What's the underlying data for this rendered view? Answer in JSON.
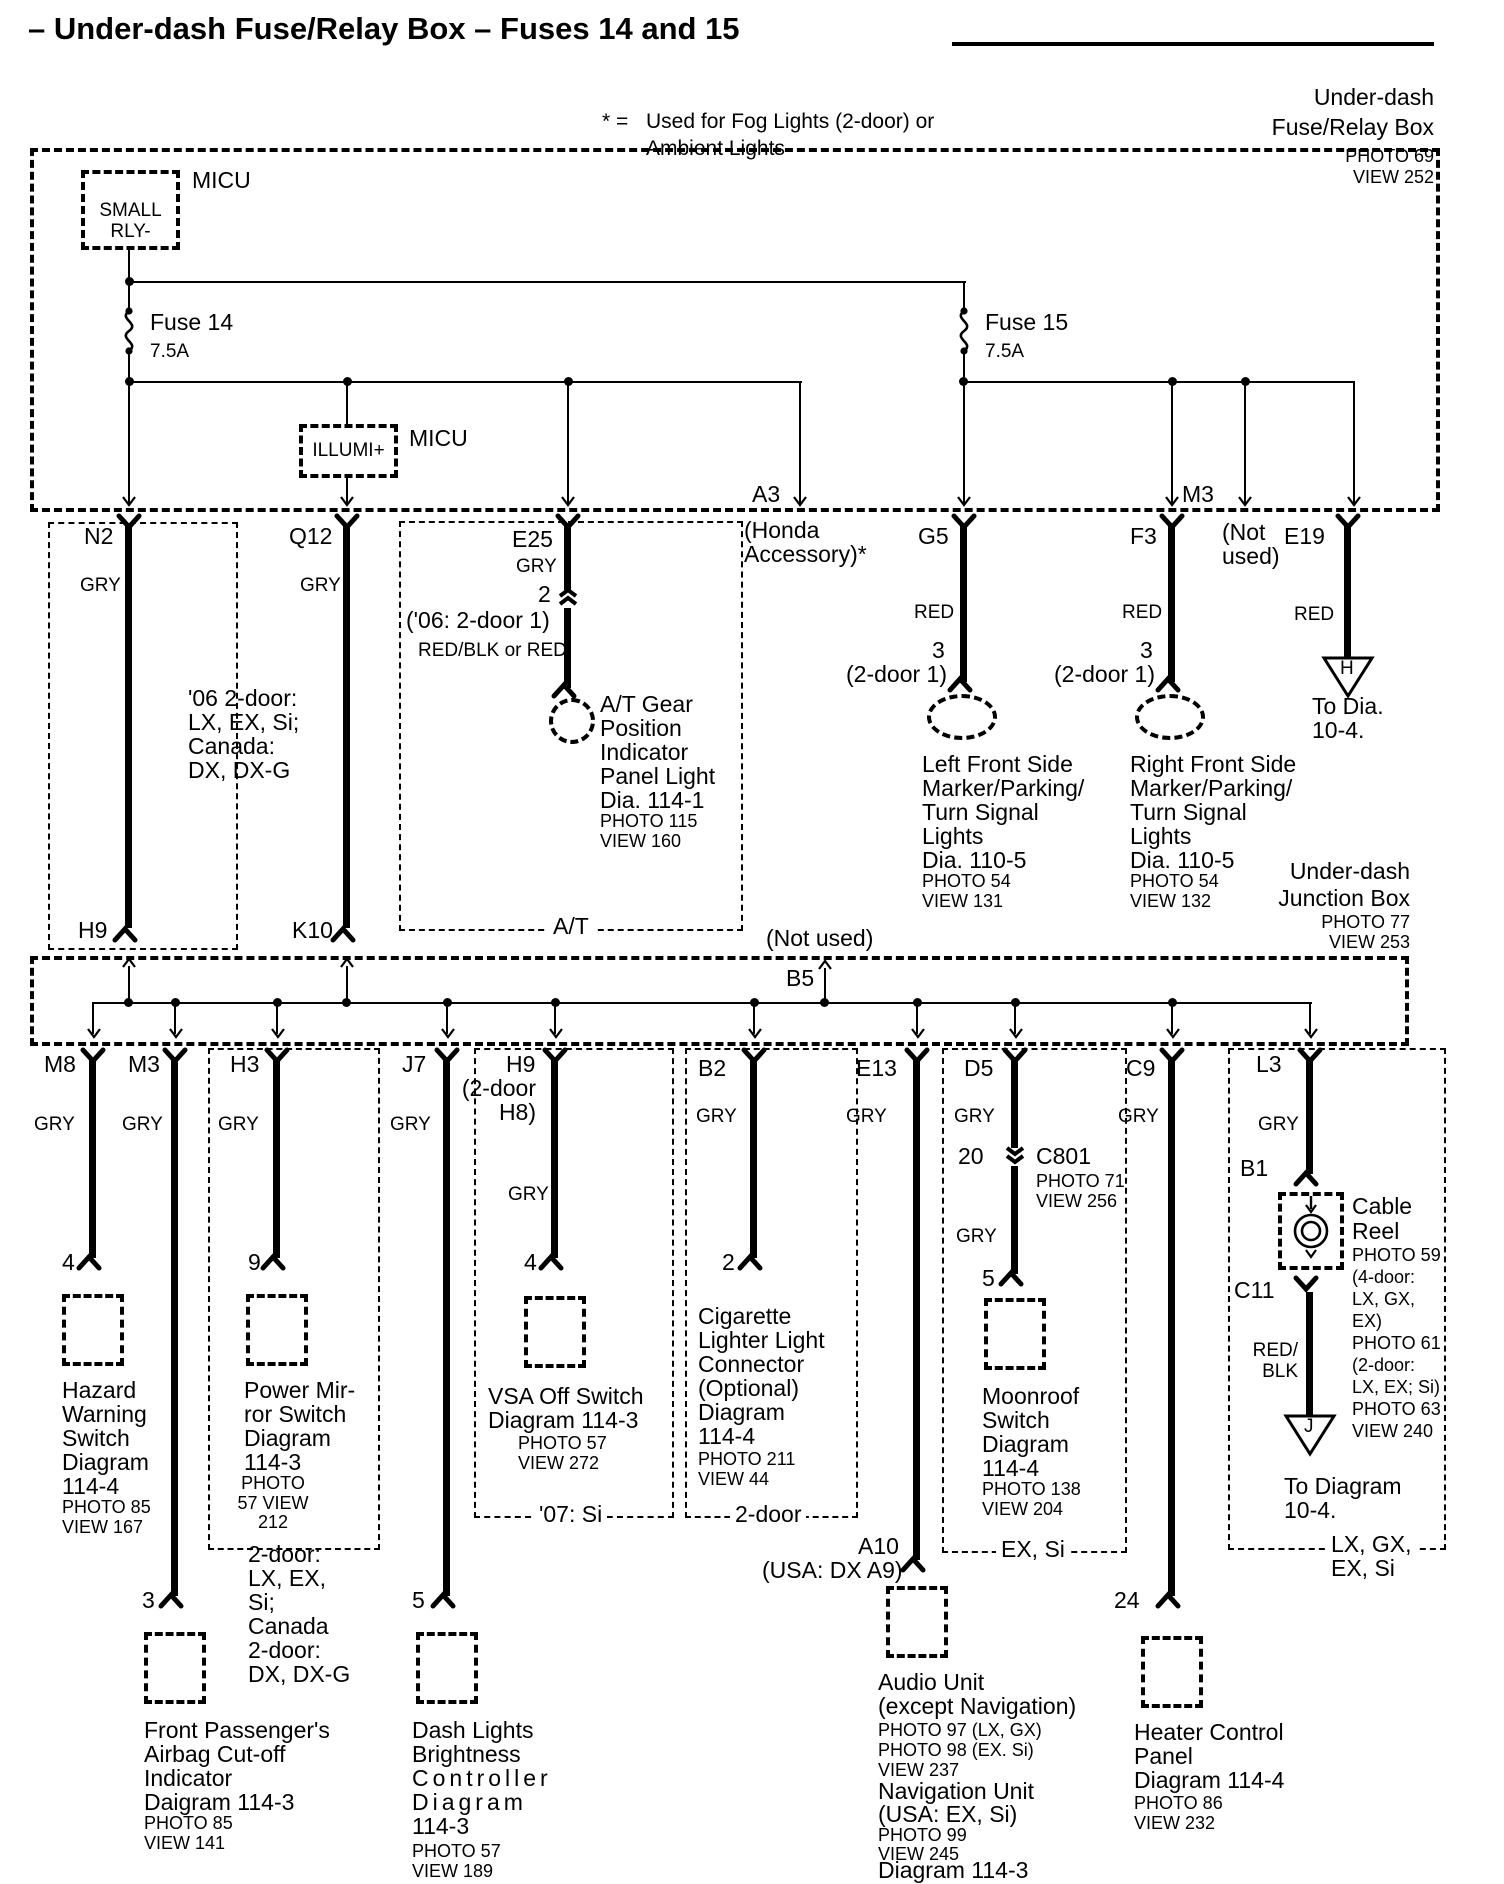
{
  "title": "– Under-dash Fuse/Relay Box – Fuses 14 and 15",
  "legend": {
    "symbol": "* =",
    "lines": [
      "Used for Fog Lights (2-door) or",
      "Ambient Lights"
    ]
  },
  "fuse_box": {
    "caption": [
      "Under-dash",
      "Fuse/Relay Box"
    ],
    "caption_ref": [
      "PHOTO 69",
      "VIEW 252"
    ],
    "micu_relay_label": "MICU",
    "small_relay": [
      "SMALL",
      "RLY-"
    ],
    "fuse14": {
      "name": "Fuse 14",
      "rating": "7.5A"
    },
    "fuse15": {
      "name": "Fuse 15",
      "rating": "7.5A"
    },
    "micu_illumi_label": "MICU",
    "illumi": "ILLUMI+"
  },
  "row1": {
    "n2": {
      "id": "N2",
      "wire_color": "GRY",
      "exit": "H9"
    },
    "q12": {
      "id": "Q12",
      "wire_color": "GRY",
      "exit": "K10"
    },
    "variant_note": [
      "'06 2-door:",
      "LX, EX, Si;",
      "Canada:",
      "DX, DX-G"
    ],
    "e25": {
      "id": "E25",
      "wire_color": "GRY",
      "pin": "2",
      "note": "('06: 2-door 1)",
      "wire_color2": "RED/BLK or RED",
      "dest": [
        "A/T Gear",
        "Position",
        "Indicator",
        "Panel Light",
        "Dia. 114-1"
      ],
      "ref": [
        "PHOTO 115",
        "VIEW 160"
      ],
      "box_label": "A/T"
    },
    "a3": {
      "id": "A3",
      "note": [
        "(Honda",
        "Accessory)*"
      ]
    },
    "g5": {
      "id": "G5",
      "wire_color": "RED",
      "pin": "3",
      "pin_note": "(2-door 1)",
      "dest": [
        "Left Front Side",
        "Marker/Parking/",
        "Turn Signal",
        "Lights",
        "Dia. 110-5"
      ],
      "ref": [
        "PHOTO 54",
        "VIEW 131"
      ]
    },
    "f3": {
      "id": "F3",
      "wire_color": "RED",
      "pin": "3",
      "pin_note": "(2-door 1)",
      "dest": [
        "Right Front Side",
        "Marker/Parking/",
        "Turn Signal",
        "Lights",
        "Dia. 110-5"
      ],
      "ref": [
        "PHOTO 54",
        "VIEW 132"
      ]
    },
    "m3": {
      "id": "M3",
      "note": [
        "(Not",
        "used)"
      ]
    },
    "e19": {
      "id": "E19",
      "wire_color": "RED",
      "tri": "H",
      "dest": [
        "To Dia.",
        "10-4."
      ]
    }
  },
  "junction_box": {
    "caption": [
      "Under-dash",
      "Junction Box"
    ],
    "caption_ref": [
      "PHOTO 77",
      "VIEW 253"
    ],
    "b5": "B5",
    "not_used": "(Not used)"
  },
  "row2": {
    "m8": {
      "id": "M8",
      "wire_color": "GRY",
      "pin": "4",
      "dest": [
        "Hazard",
        "Warning",
        "Switch",
        "Diagram",
        "114-4"
      ],
      "ref": [
        "PHOTO 85",
        "VIEW 167"
      ]
    },
    "m3": {
      "id": "M3",
      "wire_color": "GRY",
      "pin": "3",
      "dest": [
        "Front Passenger's",
        "Airbag Cut-off",
        "Indicator",
        "Daigram 114-3"
      ],
      "ref": [
        "PHOTO 85",
        "VIEW 141"
      ]
    },
    "h3": {
      "id": "H3",
      "wire_color": "GRY",
      "pin": "9",
      "dest": [
        "Power Mir-",
        "ror Switch",
        "Diagram",
        "114-3"
      ],
      "ref": [
        "PHOTO",
        "57 VIEW",
        "212"
      ],
      "note": [
        "2-door:",
        "LX, EX,",
        "Si;",
        "Canada",
        "2-door:",
        "DX, DX-G"
      ]
    },
    "j7": {
      "id": "J7",
      "wire_color": "GRY",
      "pin": "5",
      "dest": [
        "Dash Lights",
        "Brightness"
      ],
      "dest_spaced": [
        "Controller",
        "Diagram"
      ],
      "dest_end": "114-3",
      "ref": [
        "PHOTO 57",
        "VIEW 189"
      ]
    },
    "h9": {
      "id": "H9",
      "sub": [
        "(2-door",
        "H8)"
      ],
      "wire_color": "GRY",
      "pin": "4",
      "dest": [
        "VSA Off Switch",
        "Diagram 114-3"
      ],
      "ref": [
        "PHOTO 57",
        "VIEW 272"
      ],
      "box_label": "'07: Si"
    },
    "b2": {
      "id": "B2",
      "wire_color": "GRY",
      "pin": "2",
      "dest": [
        "Cigarette",
        "Lighter Light",
        "Connector",
        "(Optional)",
        "Diagram",
        "114-4"
      ],
      "ref": [
        "PHOTO 211",
        "VIEW 44"
      ],
      "box_label": "2-door"
    },
    "e13": {
      "id": "E13",
      "wire_color": "GRY",
      "out_id": "A10",
      "out_note": "(USA: DX A9)",
      "dest": [
        "Audio Unit",
        "(except Navigation)"
      ],
      "ref": [
        "PHOTO 97 (LX, GX)",
        "PHOTO 98 (EX. Si)",
        "VIEW 237"
      ],
      "dest2": [
        "Navigation Unit",
        "(USA: EX, Si)"
      ],
      "ref2": [
        "PHOTO 99",
        "VIEW 245"
      ],
      "dest3": "Diagram 114-3"
    },
    "d5": {
      "id": "D5",
      "wire_color": "GRY",
      "inline_pin": "20",
      "inline_id": "C801",
      "inline_ref": [
        "PHOTO 71",
        "VIEW 256"
      ],
      "wire_color2": "GRY",
      "pin": "5",
      "dest": [
        "Moonroof",
        "Switch",
        "Diagram",
        "114-4"
      ],
      "ref": [
        "PHOTO 138",
        "VIEW 204"
      ],
      "box_label": "EX, Si"
    },
    "c9": {
      "id": "C9",
      "wire_color": "GRY",
      "pin": "24",
      "dest": [
        "Heater Control",
        "Panel",
        "Diagram 114-4"
      ],
      "ref": [
        "PHOTO 86",
        "VIEW 232"
      ]
    },
    "l3": {
      "id": "L3",
      "wire_color": "GRY",
      "b1": "B1",
      "device": [
        "Cable",
        "Reel"
      ],
      "device_ref": [
        "PHOTO 59",
        "(4-door:",
        "LX, GX,",
        "EX)",
        "PHOTO 61",
        "(2-door:",
        "LX, EX; Si)",
        "PHOTO 63",
        "VIEW 240"
      ],
      "c11": "C11",
      "wire_color2": [
        "RED/",
        "BLK"
      ],
      "tri": "J",
      "dest": [
        "To Diagram",
        "10-4."
      ],
      "box_label": [
        "LX, GX,",
        "EX, Si"
      ]
    }
  }
}
